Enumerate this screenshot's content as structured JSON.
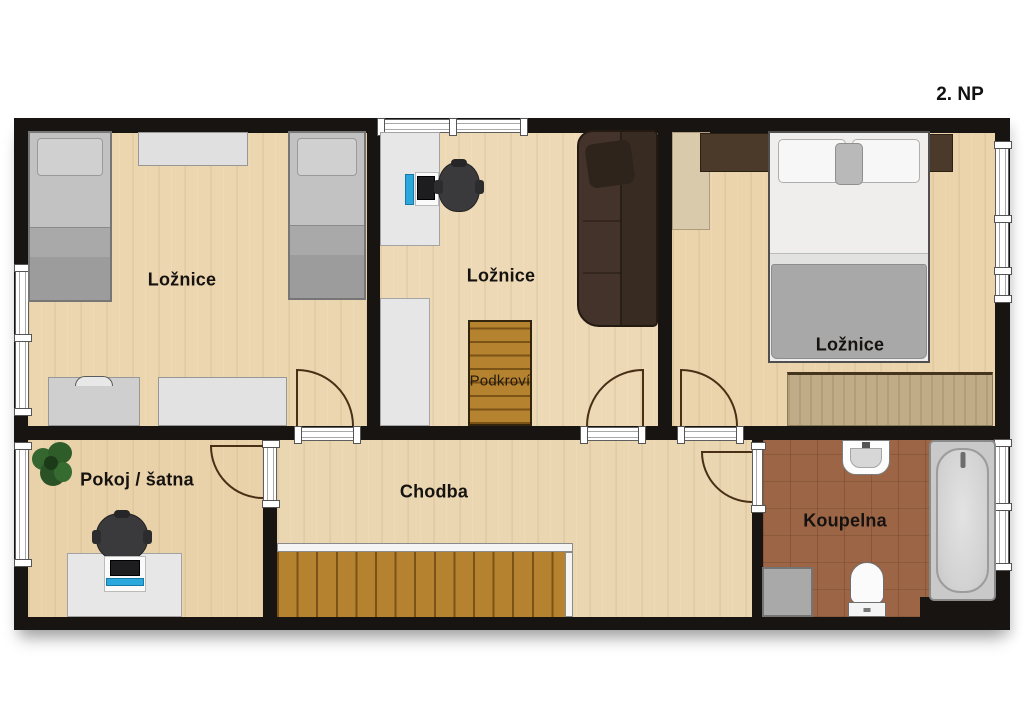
{
  "floor_label": "2. NP",
  "rooms": {
    "bedroom_left": {
      "label": "Ložnice"
    },
    "bedroom_middle": {
      "label": "Ložnice"
    },
    "bedroom_right": {
      "label": "Ložnice"
    },
    "attic_access": {
      "label": "Podkroví"
    },
    "room_closet": {
      "label": "Pokoj / šatna"
    },
    "hallway": {
      "label": "Chodba"
    },
    "bathroom": {
      "label": "Koupelna"
    }
  },
  "furniture_inventory": {
    "bedroom_left": [
      "single-bed",
      "single-bed",
      "dresser",
      "chest-of-drawers",
      "chest-of-drawers"
    ],
    "bedroom_middle": [
      "desk",
      "computer",
      "office-chair",
      "sofa",
      "wardrobe",
      "attic-staircase"
    ],
    "bedroom_right": [
      "wardrobe",
      "nightstand",
      "double-bed",
      "nightstand",
      "rug"
    ],
    "room_closet": [
      "plant",
      "office-chair",
      "desk",
      "computer"
    ],
    "hallway": [
      "staircase"
    ],
    "bathroom": [
      "sink",
      "bathtub",
      "washing-machine",
      "toilet"
    ]
  },
  "palette": {
    "wall": "#171411",
    "floor_wood": "#ecd6af",
    "floor_tile": "#9b6546",
    "stairs_wood": "#b5822f",
    "sofa_brown": "#43332a",
    "furniture_gray": "#c2c2c2",
    "accent_blue": "#2aa7dd",
    "plant_green": "#2f5d29",
    "door_arc": "#4a2f17"
  }
}
